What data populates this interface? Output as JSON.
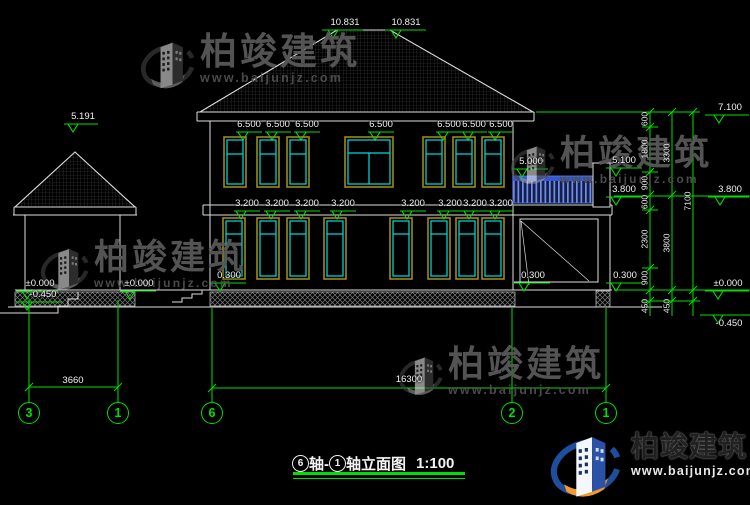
{
  "watermark": {
    "brand": "柏竣建筑",
    "url": "www.baijunjz.com"
  },
  "logo": {
    "brand": "柏竣建筑",
    "url": "www.baijunjz.com"
  },
  "title": {
    "axis_from": "6",
    "mid": "轴-",
    "axis_to": "1",
    "suffix": "轴立面图",
    "scale": "1:100"
  },
  "elevation_markers": {
    "ridge_left": "10.831",
    "ridge_right": "10.831",
    "pavilion_roof": "5.191",
    "balcony_rail": "5.000",
    "balcony_post": "5.100",
    "balcony_slab": "3.800",
    "plinth_main_left": "0.300",
    "plinth_main_right": "0.300",
    "plinth_annex_right": "0.300",
    "ground_porch": "±0.000",
    "ground_pavilion": "±0.000",
    "ground_pavilion_low": "-0.450",
    "right_top": "7.100",
    "right_mid": "3.800",
    "right_zero": "±0.000",
    "right_low": "-0.450"
  },
  "window_head_levels_floor2": [
    "6.500",
    "6.500",
    "6.500",
    "6.500",
    "6.500",
    "6.500",
    "6.500"
  ],
  "window_head_levels_floor1": [
    "3.200",
    "3.200",
    "3.200",
    "3.200",
    "3.200",
    "3.200",
    "3.200",
    "3.200"
  ],
  "dimensions": {
    "bottom_pavilion": "3660",
    "bottom_main": "16300",
    "right_chain_inner": [
      "600",
      "1800",
      "900",
      "600",
      "2300",
      "900",
      "450"
    ],
    "right_chain_middle": [
      "3300",
      "3800",
      "450"
    ],
    "right_chain_outer": [
      "7100"
    ]
  },
  "axes": [
    "3",
    "1",
    "6",
    "2",
    "1"
  ]
}
